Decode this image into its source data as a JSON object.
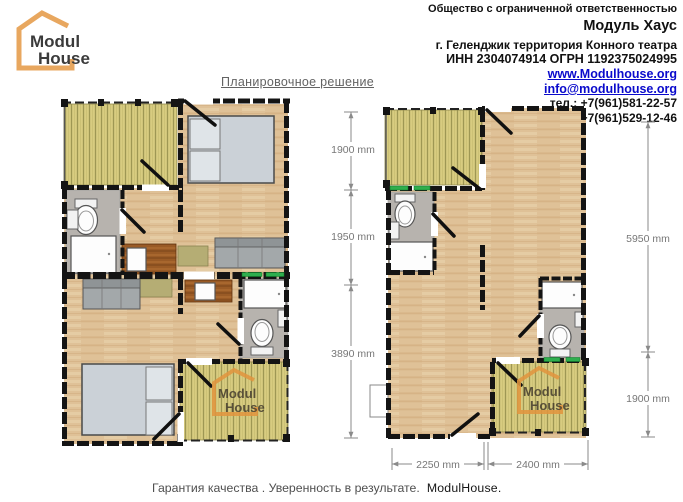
{
  "header": {
    "logo": {
      "line1": "Modul",
      "line2": "House"
    },
    "company": {
      "line1": "Общество с ограниченной ответственностью",
      "line2": "Модуль Хаус",
      "line3": "г. Геленджик территория Конного театра",
      "line4": "ИНН 2304074914 ОГРН 1192375024995",
      "website": "www.Modulhouse.org",
      "email": "info@modulhouse.org",
      "phone1": "тел.: +7(961)581-22-57",
      "phone2": "+7(961)529-12-46"
    }
  },
  "title": "Планировочное решение",
  "plans": {
    "left": {
      "watermark": {
        "line1": "Modul",
        "line2": "House"
      }
    },
    "right": {
      "watermark": {
        "line1": "Modul",
        "line2": "House"
      },
      "dimensions": {
        "left_top": "1900 mm",
        "left_middle": "1950 mm",
        "left_bottom": "3890 mm",
        "right_side": "5950 mm",
        "right_bottom": "1900 mm",
        "bottom_left": "2250 mm",
        "bottom_right": "2400 mm"
      }
    }
  },
  "footer": {
    "text": "Гарантия качества . Уверенность в результате.",
    "brand": "ModulHouse."
  },
  "colors": {
    "accent_orange": "#E8A75F",
    "link_blue": "#0A0ACC",
    "deck_yellow": "#D8CC80",
    "wood_tan": "#DFC197",
    "wall_black": "#141414",
    "bathroom_gray": "#B7B3AE",
    "window_green": "#2FAE4E",
    "kitchen_brown": "#9A5B26"
  }
}
